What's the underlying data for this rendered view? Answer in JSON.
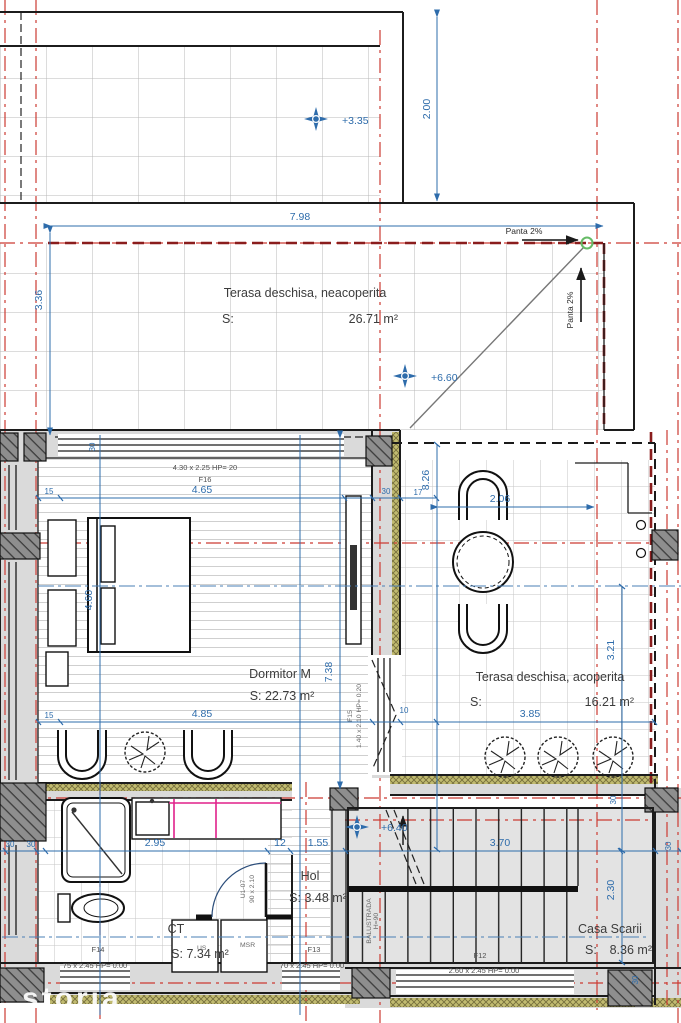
{
  "watermark": "storia",
  "rooms": {
    "terasa_top": {
      "name": "Terasa deschisa, neacoperita",
      "s": "S:",
      "area": "26.71 m²"
    },
    "dormitor": {
      "name": "Dormitor M",
      "area": "S: 22.73 m²"
    },
    "terasa_right": {
      "name": "Terasa deschisa, acoperita",
      "s": "S:",
      "area": "16.21 m²"
    },
    "hol": {
      "name": "Hol",
      "area": "S: 3.48 m²"
    },
    "ct": {
      "name": "CT",
      "area": "S: 7.34 m²"
    },
    "casa_scarii": {
      "name": "Casa Scarii",
      "s": "S:",
      "area": "8.36 m²"
    }
  },
  "elevations": {
    "level_335": "+3.35",
    "level_660": "+6.60",
    "level_640": "+6.40"
  },
  "slope": {
    "horizontal": "Panta 2%",
    "vertical": "Panta 2%"
  },
  "openings": {
    "f16": {
      "code": "F16",
      "size": "4.30 x 2.25 HP= 20"
    },
    "f15": {
      "code": "F15",
      "size": "1.40 x 2.10 HP= 0.20"
    },
    "f14": {
      "code": "F14",
      "size": "75 x 2.45 HP= 0.00"
    },
    "f13": {
      "code": "F13",
      "size": "70 x 2.45 HP= 0.00"
    },
    "f12": {
      "code": "F12",
      "size": "2.60 x 2.45 HP= 0.00"
    },
    "door_u107": {
      "code": "U1-07",
      "size": "90 x 2.10"
    },
    "balustrade": {
      "label": "BALUSTRADA",
      "height": "H=90"
    }
  },
  "appliances": {
    "us": "US",
    "msr": "MSR"
  },
  "dimensions": {
    "top_width": "7.98",
    "top_offset": "2.00",
    "top_height": "3.36",
    "dorm_width_top": "4.65",
    "dorm_width_bottom": "4.85",
    "dorm_height": "4.60",
    "dorm_total_height": "7.38",
    "terrace_width": "2.06",
    "terrace_total_height": "8.26",
    "terrace_inner_height": "3.21",
    "terrace_bottom_width": "3.85",
    "ct_width": "2.95",
    "hol_seg_a": "12",
    "hol_seg_b": "1.55",
    "stair_width": "3.70",
    "stair_height": "2.30",
    "dim_30": "30",
    "dim_17": "17",
    "dim_15": "15",
    "dim_10": "10"
  }
}
